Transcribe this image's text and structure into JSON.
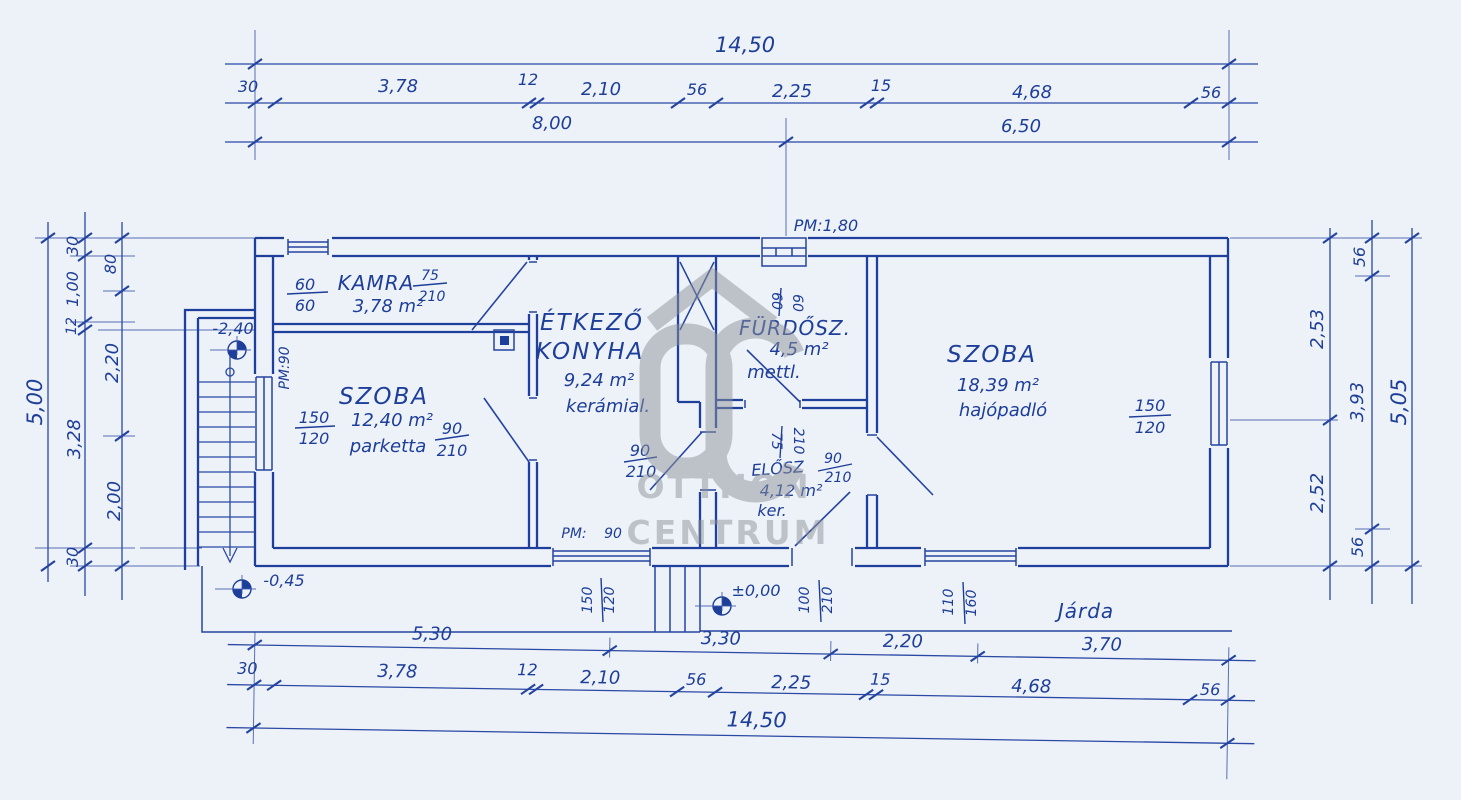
{
  "colors": {
    "ink": "#1d3e99",
    "line": "#2a49a4",
    "paper": "#edf1f8",
    "watermark": "#8e9399"
  },
  "watermark": {
    "logo": "OC",
    "logo_icon": "house-roof",
    "line1": "OTTHON",
    "line2": "CENTRUM"
  },
  "dims": {
    "top": {
      "total": "14,50",
      "segments": [
        "30",
        "3,78",
        "12",
        "2,10",
        "56",
        "2,25",
        "15",
        "4,68",
        "56"
      ],
      "subtotals": [
        "8,00",
        "6,50"
      ]
    },
    "bottom": {
      "upper": [
        "5,30",
        "3,30",
        "2,20",
        "3,70"
      ],
      "segments": [
        "30",
        "3,78",
        "12",
        "2,10",
        "56",
        "2,25",
        "15",
        "4,68",
        "56"
      ],
      "total": "14,50"
    },
    "left": {
      "total": "5,00",
      "mid": [
        "30",
        "1,00",
        "12",
        "3,28",
        "30"
      ],
      "inner": [
        "80",
        "2,20",
        "2,00"
      ]
    },
    "right": {
      "total": "5,05",
      "mid": [
        "56",
        "3,93",
        "56"
      ],
      "inner": [
        "2,53",
        "2,52"
      ]
    }
  },
  "rooms": {
    "kamra": {
      "name": "KAMRA",
      "area": "3,78 m²"
    },
    "szoba1": {
      "name": "SZOBA",
      "area": "12,40 m²",
      "floor": "parketta"
    },
    "konyha": {
      "name_line1": "ÉTKEZŐ",
      "name_line2": "KONYHA",
      "area": "9,24 m²",
      "floor": "kerámial."
    },
    "furdoszoba": {
      "name": "FÜRDŐSZ.",
      "area": "4,5 m²",
      "floor": "mettl."
    },
    "eloszoba": {
      "name": "ELŐSZ",
      "area": "4,12 m²",
      "floor": "ker."
    },
    "szoba2": {
      "name": "SZOBA",
      "area": "18,39 m²",
      "floor": "hajópadló"
    },
    "jarda": {
      "name": "Járda"
    }
  },
  "openings": {
    "kamra_window": {
      "w": "60",
      "h": "60"
    },
    "kamra_door": {
      "w": "75",
      "h": "210"
    },
    "szoba1_window": {
      "w": "150",
      "h": "120"
    },
    "szoba1_door": {
      "w": "90",
      "h": "210"
    },
    "konyha_door": {
      "w": "90",
      "h": "210"
    },
    "furdo_window": {
      "w": "60",
      "h": "60"
    },
    "furdo_door": {
      "w": "75",
      "h": "210"
    },
    "szoba2_door": {
      "w": "90",
      "h": "210"
    },
    "szoba2_window": {
      "w": "150",
      "h": "120"
    },
    "kitchen_window": {
      "w": "150",
      "h": "120"
    },
    "entry_door": {
      "w": "100",
      "h": "210"
    },
    "terrace_window": {
      "w": "110",
      "h": "160"
    }
  },
  "annotations": {
    "pm_top": "PM:1,80",
    "pm_left": "PM:90",
    "pm_kitchen_label": "PM:",
    "pm_kitchen_value": "90",
    "level_cellar": "-2,40",
    "level_terrace": "-0,45",
    "level_ground": "±0,00"
  }
}
